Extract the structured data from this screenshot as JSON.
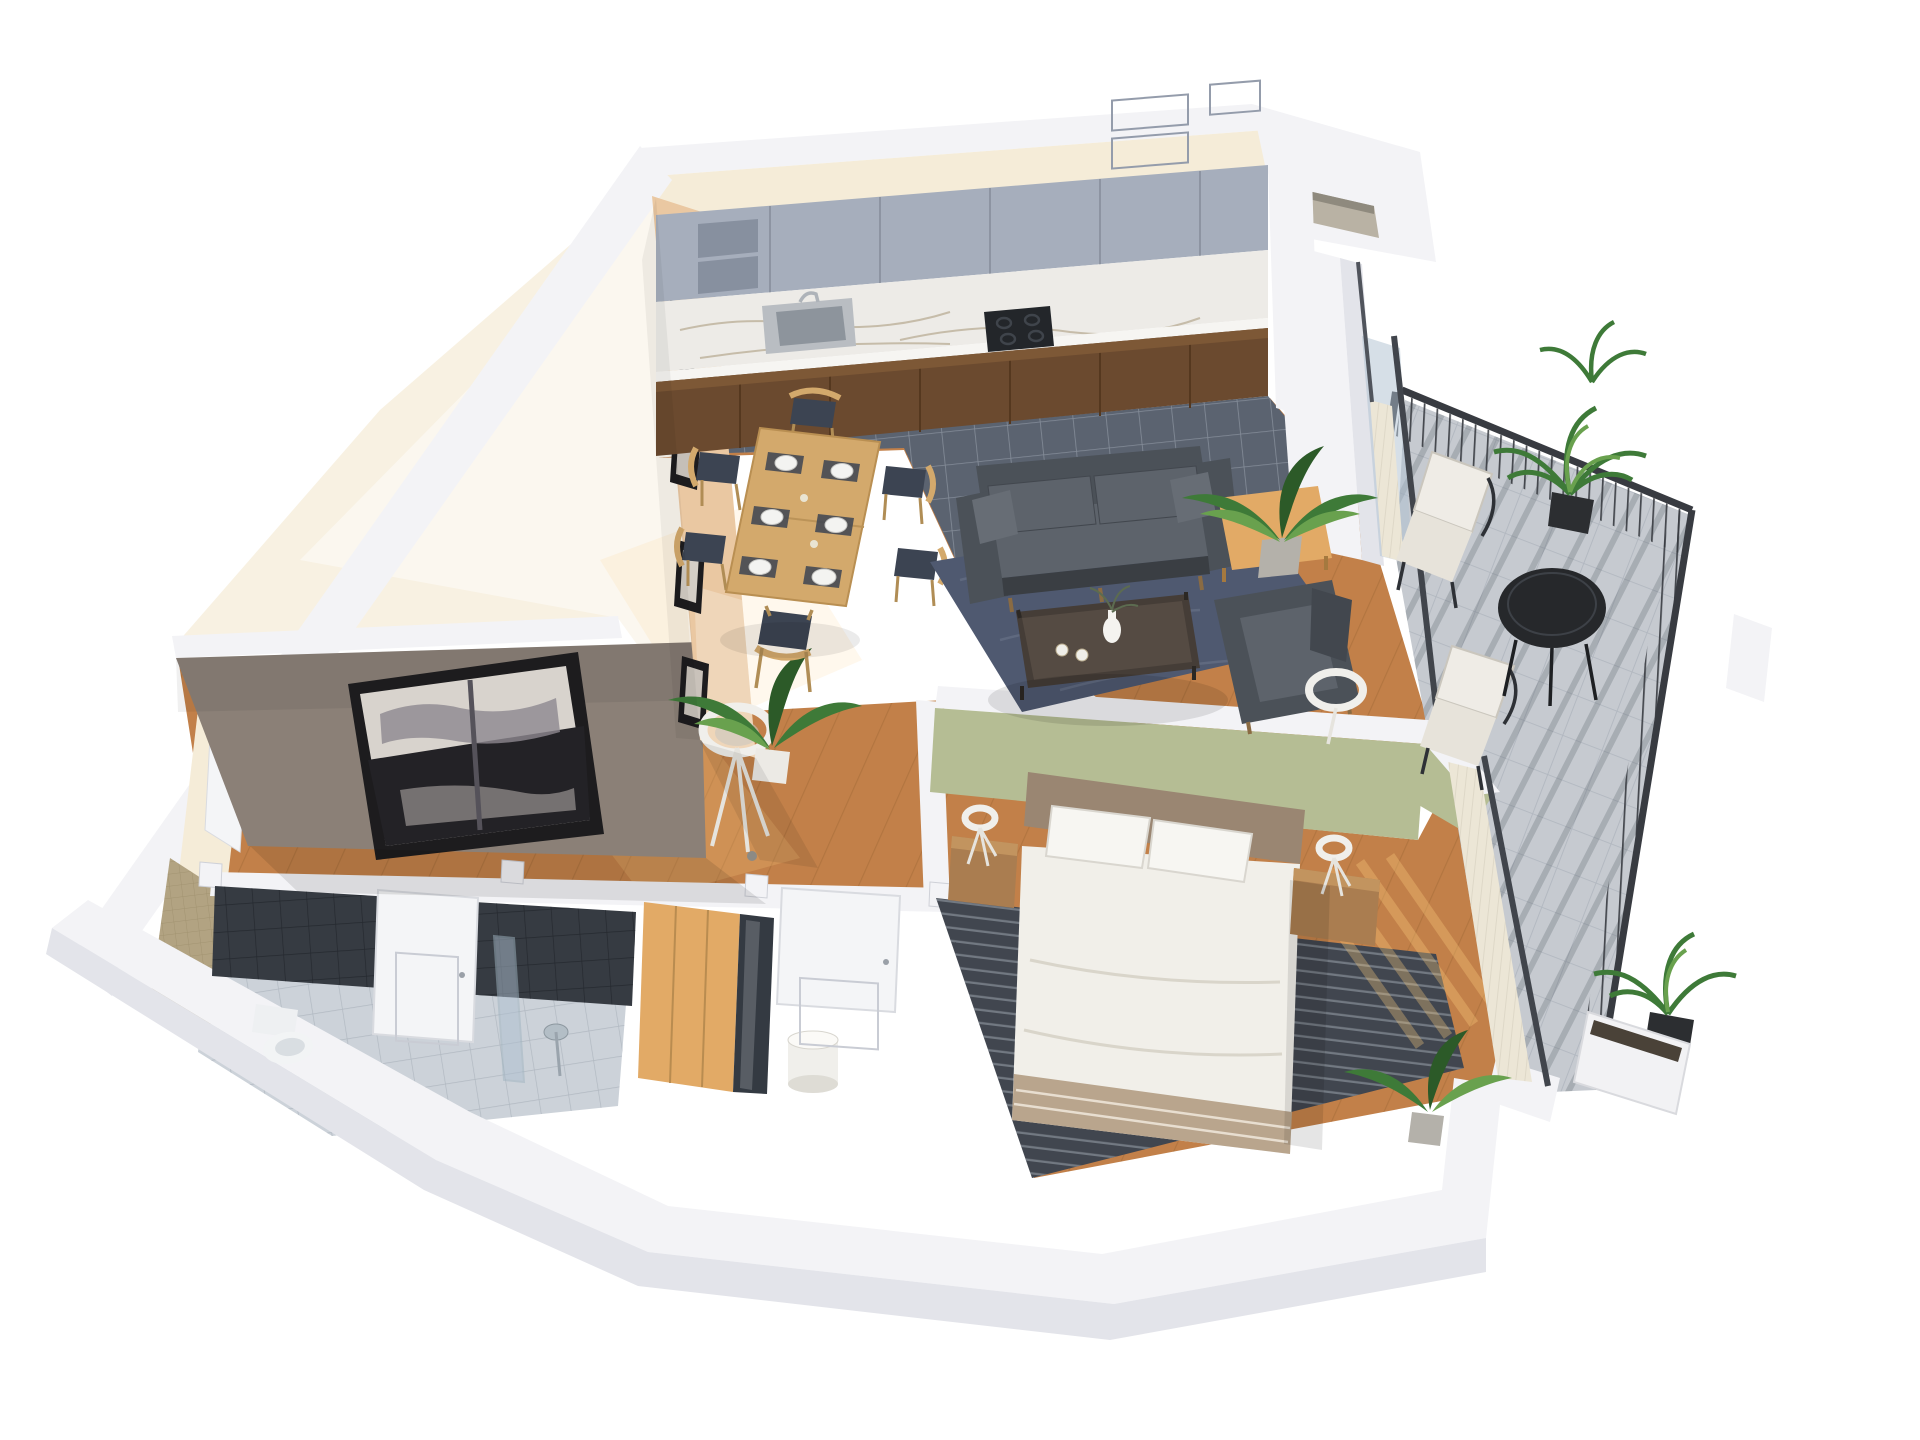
{
  "palette": {
    "wall_top": "#f3f3f6",
    "wall_face": "#e3e4ea",
    "wall_shadow": "#d2d4dc",
    "cream": "#f5ecd8",
    "tan_wall": "#eac8a2",
    "taupe_wall": "#8b8077",
    "green_wall": "#b5bd94",
    "wood": "#c28049",
    "wood_light": "#e2aa66",
    "wood_dark": "#8f5e2c",
    "tile_kitchen": "#5b6370",
    "tile_grout": "#939aa6",
    "bath_floor": "#ccd2d9",
    "bath_tile_dark": "#363b42",
    "bath_tile_beige": "#b2a382",
    "marble": "#edebe7",
    "marble_vein": "#bcb09a",
    "cabinet_upper": "#a6aebc",
    "cabinet_base": "#6b4a2f",
    "sofa": "#4b5158",
    "sofa_light": "#5d636b",
    "rug_living": "#4f5970",
    "rug_bedroom": "#41464f",
    "rug_stripe": "#9aa1ab",
    "bed_linen": "#f1efe9",
    "headboard": "#9a8672",
    "pillow": "#f7f6f2",
    "nightstand": "#aa7d50",
    "table_wood": "#d3a96c",
    "chair_seat": "#3c4452",
    "coffee_table": "#453d37",
    "curtain": "#ece6d6",
    "door": "#f4f5f7",
    "door_line": "#c9ccd4",
    "glass": "#aebfd0",
    "rail": "#383b41",
    "paver": "#c6cad0",
    "paver_grout": "#adb3bb",
    "plant": "#3e7a38",
    "plant_dark": "#2c5a28",
    "plant_light": "#69a14e",
    "pot_white": "#eceae5",
    "pot_black": "#2c2e31",
    "pot_gray": "#b4b1aa",
    "lamp_white": "#f0efeb",
    "metal": "#b9bdc2",
    "hob": "#23262a",
    "painting_dark": "#1d1c1e",
    "painting_light": "#d8d3cd",
    "sun": "#ffcf7e"
  },
  "scene": {
    "type": "isometric-3d-floor-plan",
    "rooms": [
      {
        "name": "Kitchen",
        "floor": "dark gray tile",
        "items": [
          "gray upper cabinets",
          "open shelves",
          "marble backsplash and countertop",
          "sink with faucet",
          "induction hob",
          "walnut base cabinets"
        ]
      },
      {
        "name": "Dining area",
        "floor": "oak plank",
        "items": [
          "wooden dining table",
          "6 chairs",
          "6 place settings with plates and cutlery",
          "4 framed pictures on tan wall"
        ]
      },
      {
        "name": "Living area",
        "floor": "oak plank",
        "items": [
          "dark gray 2-seat sofa",
          "dark gray armchair",
          "dark wood coffee table",
          "white vase",
          "2 cups",
          "blue-gray area rug",
          "white ring floor lamp",
          "potted plant on wood side table",
          "white curtain at balcony door"
        ]
      },
      {
        "name": "Bedroom",
        "floor": "oak plank",
        "accent_wall": "sage green",
        "items": [
          "double bed with white duvet",
          "2 white pillows",
          "taupe upholstered headboard",
          "2 wooden nightstands",
          "2 white tripod table lamps",
          "dark striped rug",
          "wardrobe with wood and glass doors",
          "white cylinder table lamp",
          "white curtain on glass wall",
          "potted plant"
        ]
      },
      {
        "name": "Bathroom",
        "floor": "light gray tile",
        "items": [
          "toilet",
          "walk-in shower with glass screen and rain head",
          "dark gray tiled walls",
          "beige mosaic tiled wall",
          "white door"
        ]
      },
      {
        "name": "Hallway / entry",
        "floor": "oak plank",
        "items": [
          "white tripod floor lamp",
          "potted plant",
          "white interior doors",
          "large abstract painting on taupe wall"
        ]
      },
      {
        "name": "Spare room",
        "floor": "pale screed",
        "items": []
      },
      {
        "name": "Balcony",
        "floor": "concrete pavers",
        "items": [
          "black slatted railing",
          "2 lounge chairs with white cushions",
          "round black bistro table",
          "3 potted plants",
          "white planter box",
          "white partition panel"
        ]
      }
    ],
    "counts": {
      "dining_chairs": 6,
      "place_settings": 6,
      "bed_pillows": 2,
      "framed_pictures": 4,
      "balcony_lounge_chairs": 2,
      "doors_visible": 5
    }
  }
}
